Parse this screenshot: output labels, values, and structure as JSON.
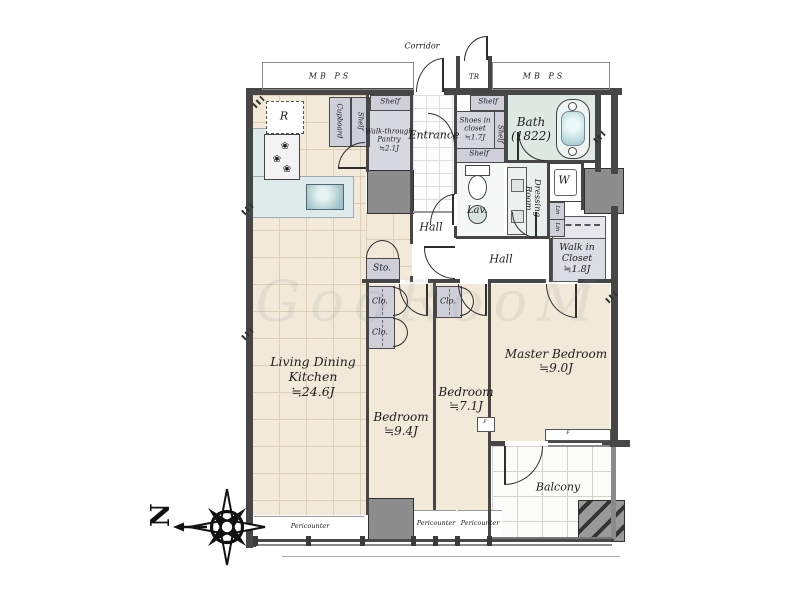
{
  "watermark": "GooRooM",
  "compass": {
    "north": "N"
  },
  "corridor": {
    "label": "Corridor",
    "mb_ps_left": "MB PS",
    "mb_ps_right": "MB PS",
    "tr": "TR"
  },
  "rooms": {
    "ldk": "Living Dining\nKitchen\n≒24.6J",
    "bedroom1": "Bedroom\n≒9.4J",
    "bedroom2": "Bedroom\n≒7.1J",
    "master_bedroom": "Master Bedroom\n≒9.0J",
    "entrance": "Entrance",
    "hall_west": "Hall",
    "hall_center": "Hall",
    "bath": "Bath\n(1822)",
    "lav": "Lav.",
    "dressing_room": "Dressing\nRoom",
    "walk_in_closet": "Walk in\nCloset\n≒1.8J",
    "shoes_in_closet": "Shoes in\ncloset\n≒1.7J",
    "pantry": "Walk-through\nPantry\n≒2.1J",
    "balcony": "Balcony"
  },
  "storage": {
    "cupboard": "Cupboard",
    "shelf_kitchen": "Shelf",
    "shelf_pantry": "Shelf",
    "shelf_shoes_top": "Shelf",
    "shelf_shoes_right": "Shelf",
    "shelf_shoes_bottom": "Shelf",
    "sto": "Sto.",
    "clo_1": "Clo.",
    "clo_2": "Clo.",
    "clo_3": "Clo.",
    "lin_1": "Lin",
    "lin_2": "Lin"
  },
  "appliances": {
    "refrigerator": "R",
    "washer": "W"
  },
  "windows": {
    "fix_1": "F",
    "fix_2": "F"
  },
  "pericounter": [
    "Pericounter",
    "Pericounter",
    "Pericounter"
  ]
}
